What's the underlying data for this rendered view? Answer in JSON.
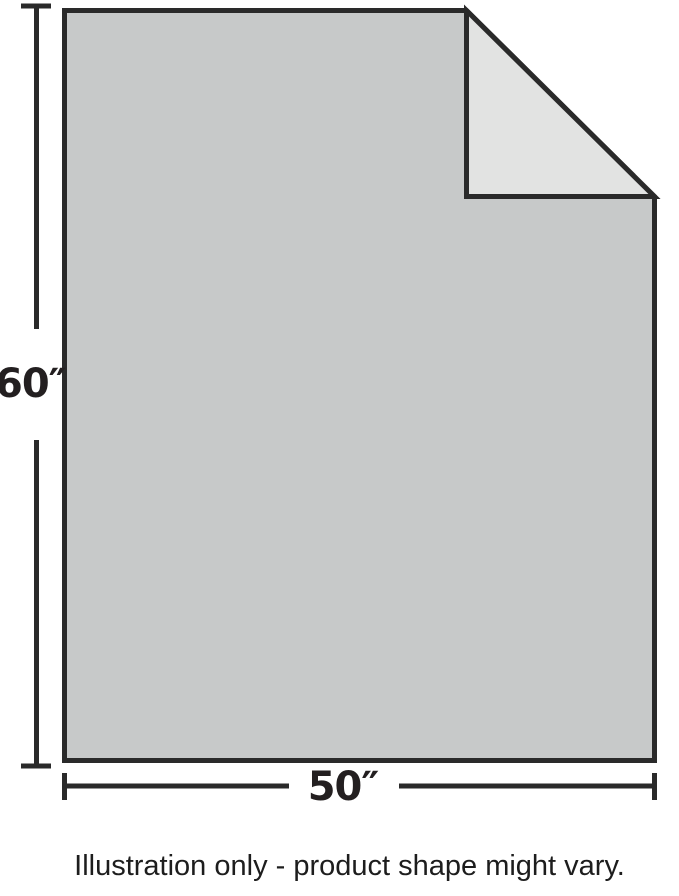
{
  "dimensions": {
    "height_label": "60″",
    "width_label": "50″"
  },
  "caption": "Illustration only - product shape might vary.",
  "colors": {
    "product_fill": "#c7c9c9",
    "fold_fill": "#e2e3e2",
    "line": "#2a2a2a",
    "label_text": "#231f20",
    "caption_text": "#1d1d1d",
    "background": "#ffffff"
  }
}
